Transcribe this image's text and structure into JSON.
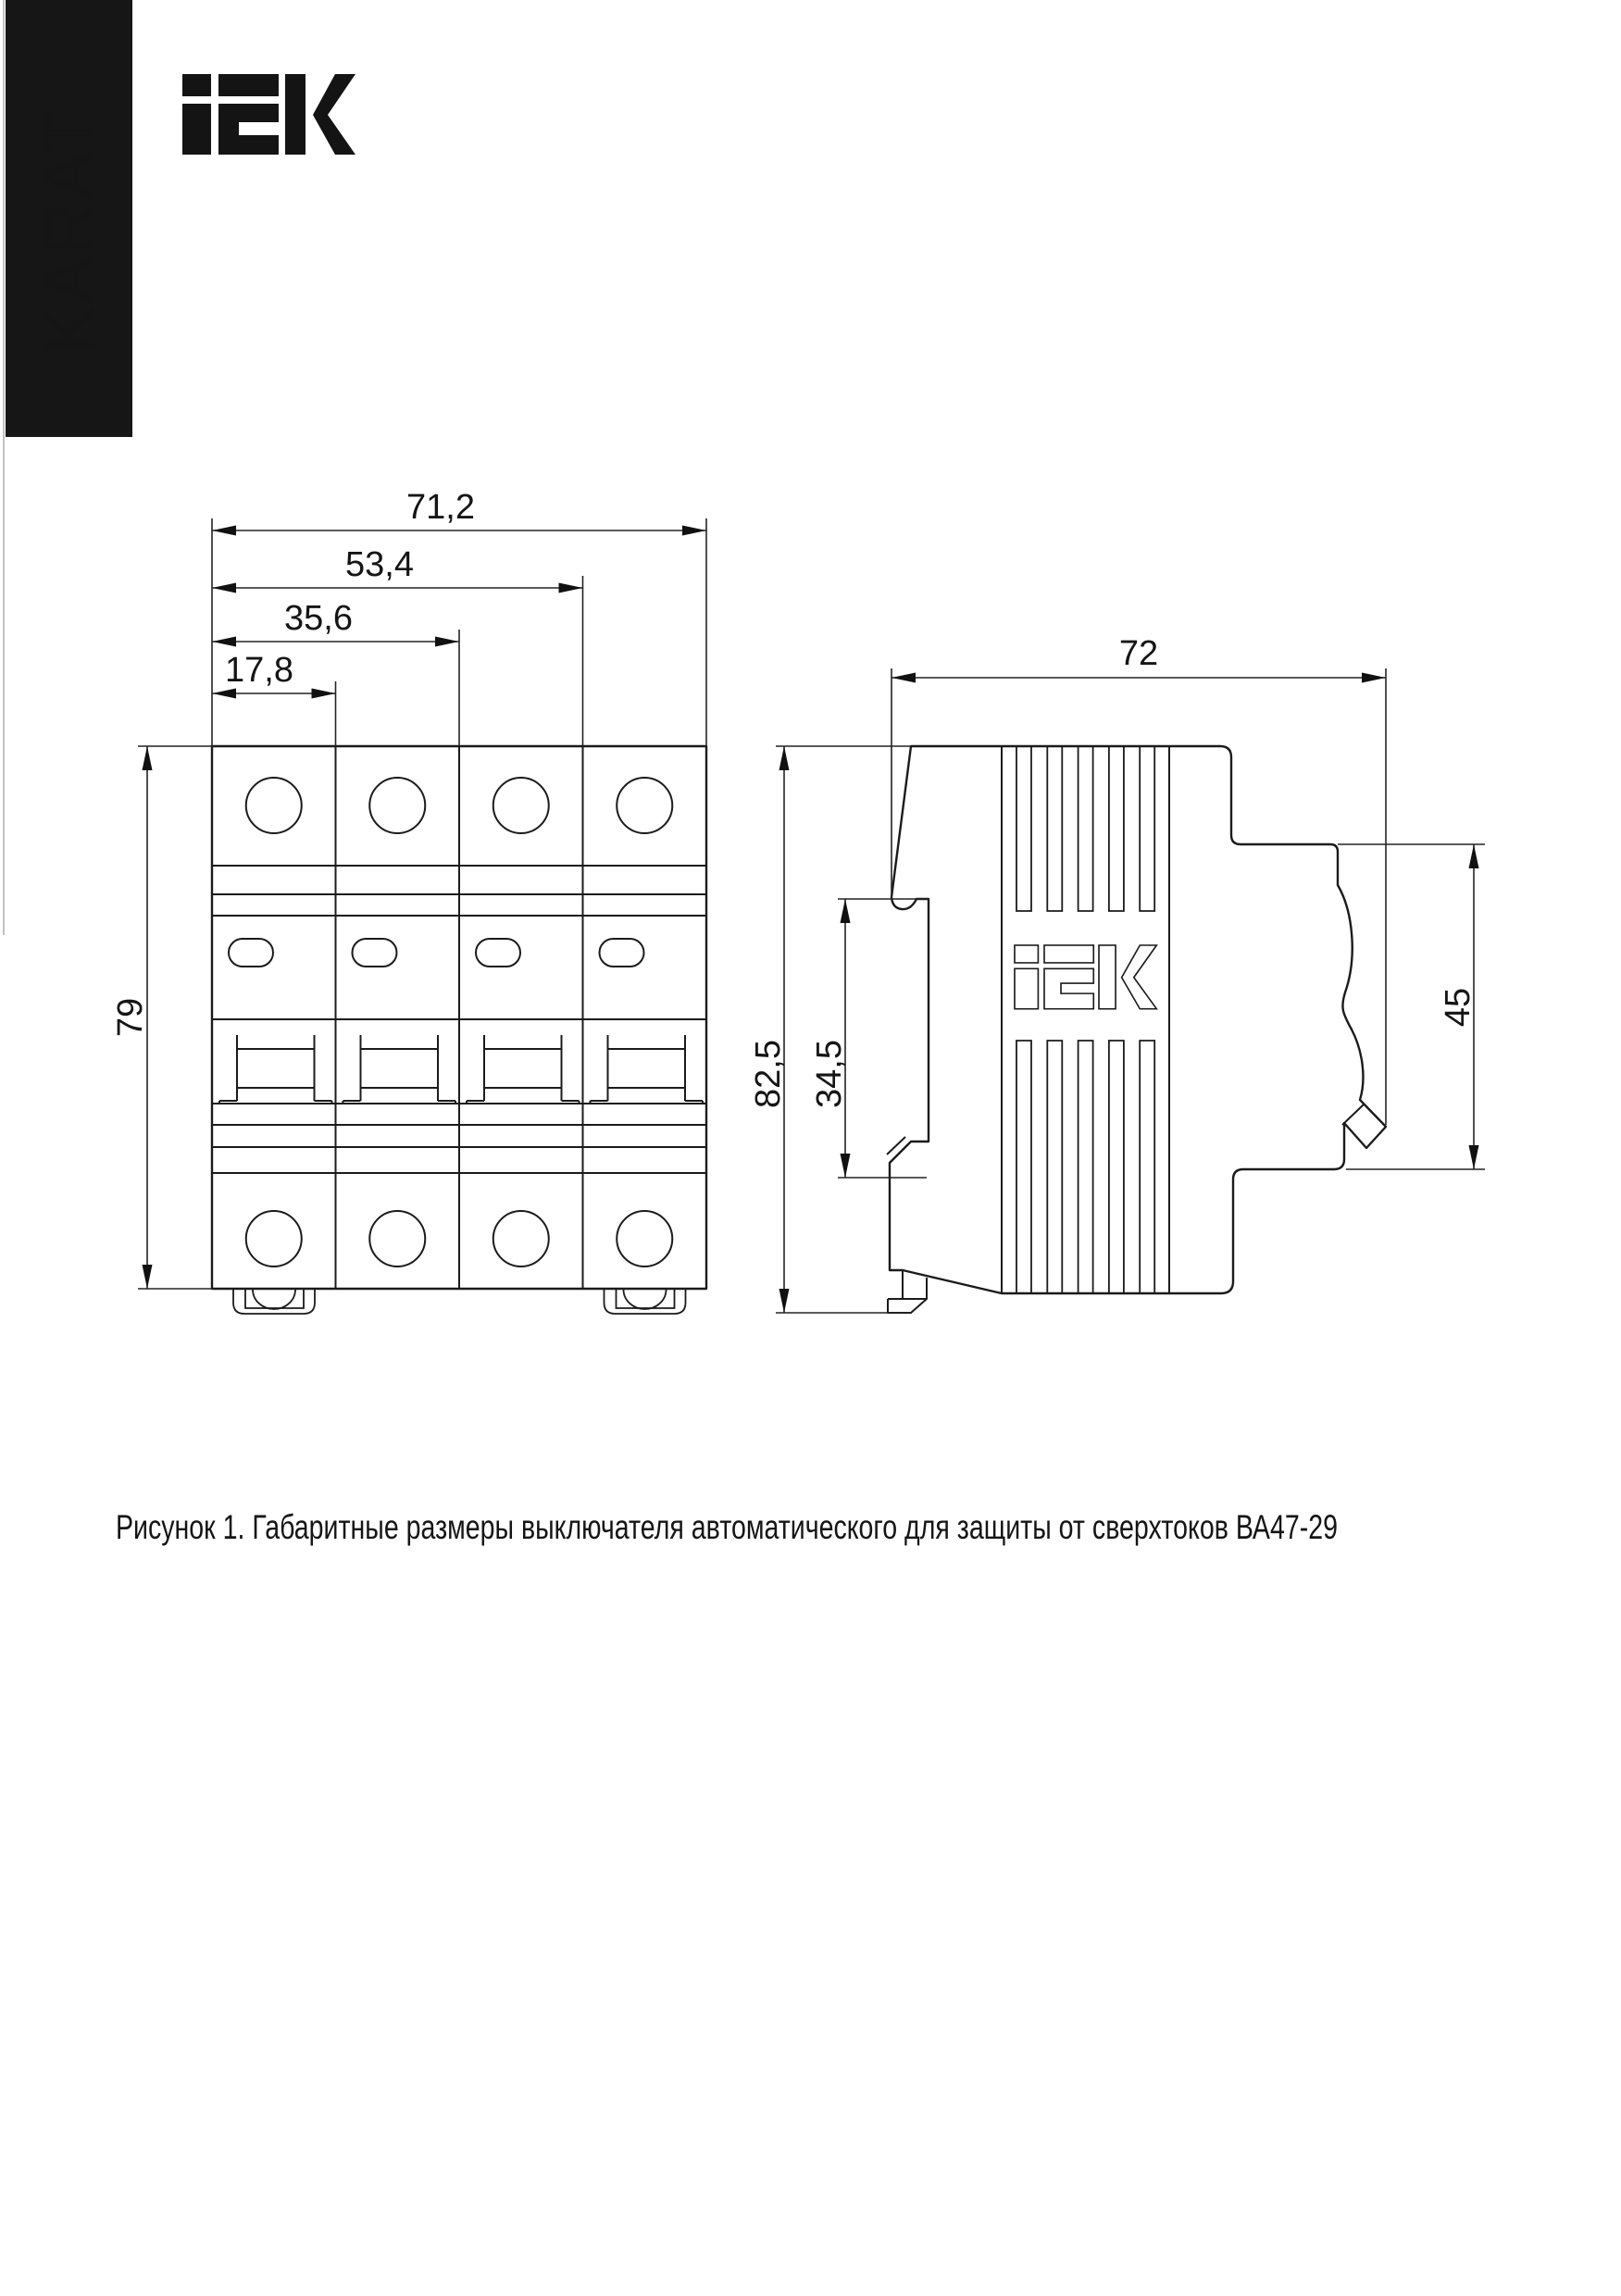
{
  "page": {
    "background": "#ffffff",
    "line_color": "#1b1b1b",
    "banner_color": "#161616"
  },
  "brand": {
    "banner_text": "KARAT",
    "logo_name": "IEK"
  },
  "figure": {
    "caption": "Рисунок 1. Габаритные размеры выключателя автоматического для защиты от сверхтоков ВА47-29",
    "front_view": {
      "name": "front-view",
      "dims": {
        "width_total": "71,2",
        "width_three_modules": "53,4",
        "width_two_modules": "35,6",
        "width_one_module": "17,8",
        "height": "79"
      }
    },
    "side_view": {
      "name": "side-view",
      "dims": {
        "depth": "72",
        "height_total": "82,5",
        "din_slot_height": "34,5",
        "front_face_height": "45"
      }
    }
  }
}
